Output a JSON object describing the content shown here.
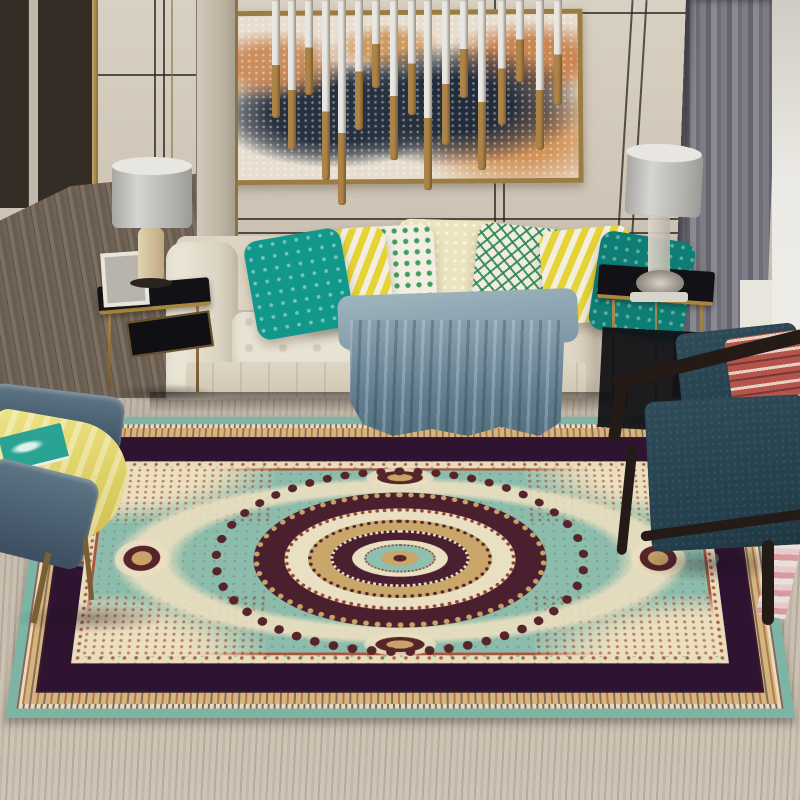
{
  "scene": {
    "description": "Living room photo: teal vintage Persian medallion area rug on light wood floor, cream tufted sofa with teal/yellow/green patterned pillows, blue-grey throw blanket, abstract wall art with brass pendant rods, two black-and-gold side tables with grey drum lamps, blue leather bench with yellow towel at lower left, dark teal wood-frame armchair at lower right, grey curtain on the right",
    "room_type": "living room",
    "focal_object": "teal medallion persian rug"
  },
  "palette": {
    "wall": "#cfc6b8",
    "trim": "#2a241d",
    "gold": "#8a7347",
    "frameGold": "#9b7c43",
    "paintBase": "#e7ded0",
    "paintNavy": "#26303e",
    "paintOrange": "#c98552",
    "rodWhite": "#e9e7e2",
    "rodGold": "#ad8448",
    "curtainGray": "#8b8992",
    "sheer": "#eceae4",
    "hallFloor": "#6f6256",
    "tblBlack": "#121216",
    "tblGold": "#a8863e",
    "lampShade": "#c9c7c3",
    "sofa": "#e7e0d0",
    "throwBlue": "#7e98a8",
    "throwDark": "#5a7182",
    "pTeal": "#12988a",
    "pTealDark": "#0e7d74",
    "pYellow": "#e6d437",
    "pGreen": "#3f9e5e",
    "pCream": "#ece4bd",
    "benchBlue": "#51677a",
    "towelYellow": "#e0d465",
    "bookTeal": "#2aa392",
    "chairWood": "#241b16",
    "chairTeal": "#2c4854",
    "chairPillowRed": "#b5544a",
    "floor": "#c9bfb0",
    "rugTeal": "#7db5a4",
    "rugField": "#8cbcab",
    "rugCream": "#ecdfc0",
    "rugTan": "#c8a266",
    "rugMaroon": "#55252a",
    "rugDark": "#2e1430",
    "rugRust": "#96442e"
  },
  "pendant": {
    "rods": [
      {
        "x": 272,
        "len": 118,
        "gold": 55
      },
      {
        "x": 288,
        "len": 150,
        "gold": 60
      },
      {
        "x": 305,
        "len": 95,
        "gold": 50
      },
      {
        "x": 322,
        "len": 180,
        "gold": 62
      },
      {
        "x": 338,
        "len": 205,
        "gold": 65
      },
      {
        "x": 355,
        "len": 130,
        "gold": 55
      },
      {
        "x": 372,
        "len": 88,
        "gold": 50
      },
      {
        "x": 390,
        "len": 160,
        "gold": 60
      },
      {
        "x": 408,
        "len": 115,
        "gold": 55
      },
      {
        "x": 424,
        "len": 190,
        "gold": 62
      },
      {
        "x": 442,
        "len": 145,
        "gold": 58
      },
      {
        "x": 460,
        "len": 98,
        "gold": 50
      },
      {
        "x": 478,
        "len": 170,
        "gold": 60
      },
      {
        "x": 498,
        "len": 125,
        "gold": 55
      },
      {
        "x": 516,
        "len": 82,
        "gold": 48
      },
      {
        "x": 536,
        "len": 150,
        "gold": 60
      },
      {
        "x": 554,
        "len": 105,
        "gold": 52
      }
    ]
  }
}
